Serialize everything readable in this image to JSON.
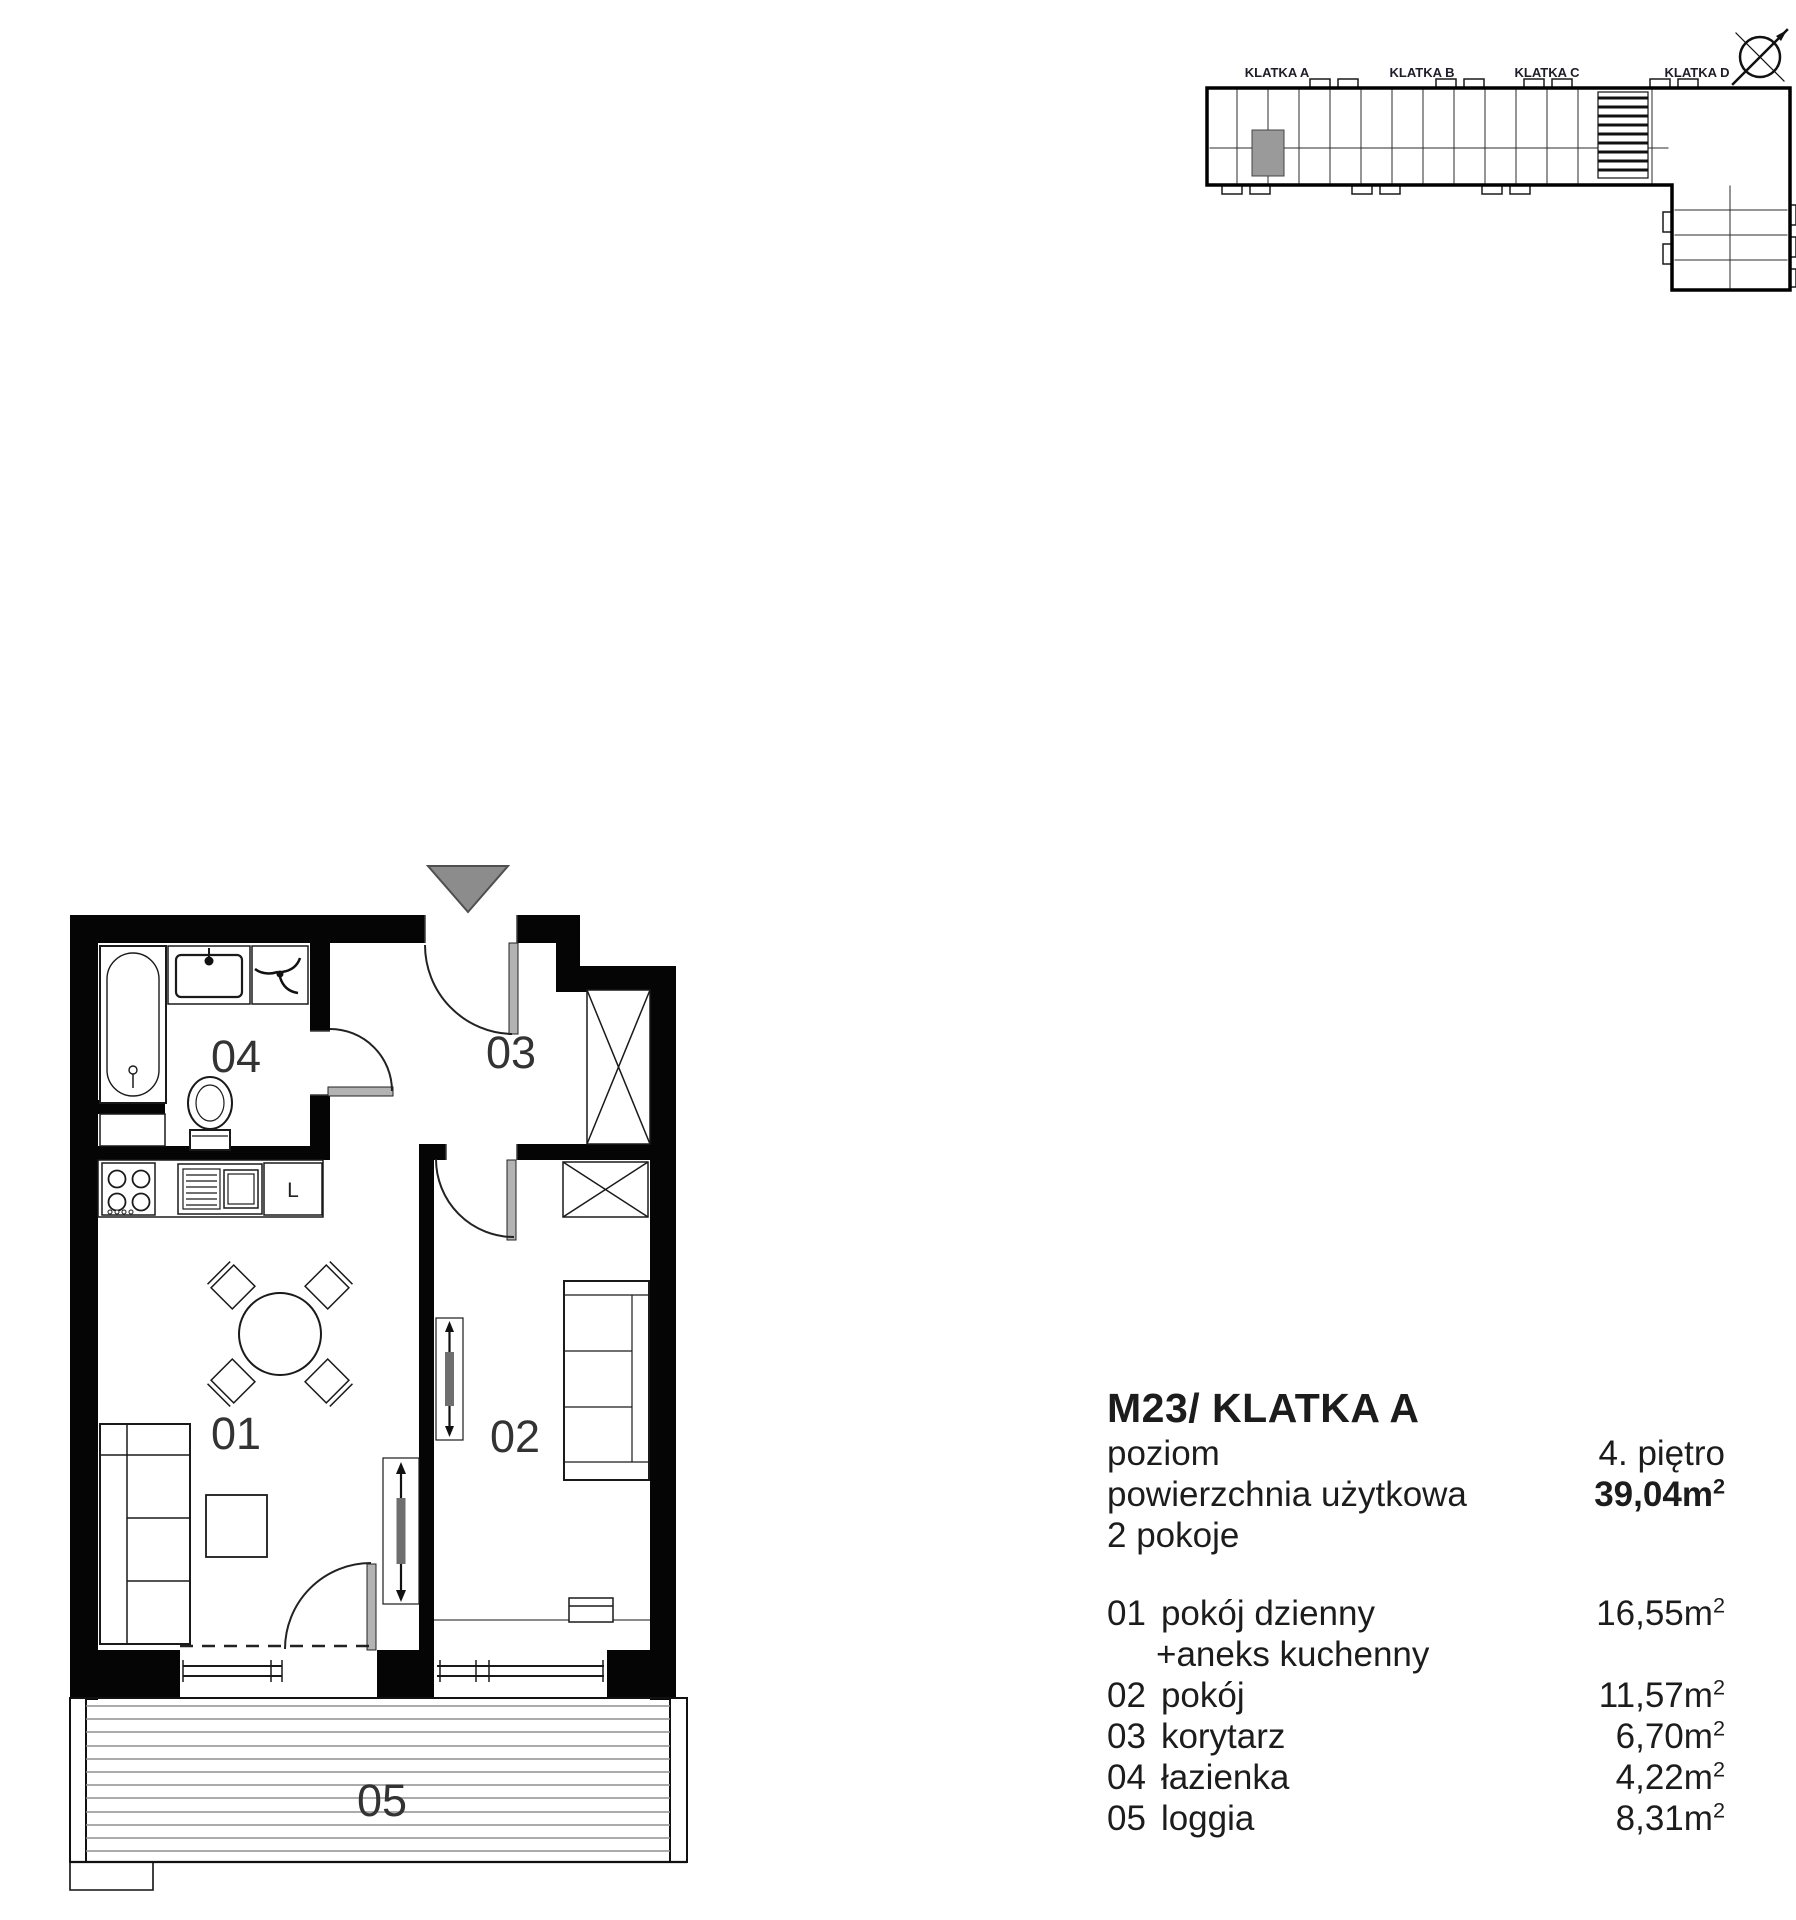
{
  "minimap": {
    "labels": [
      "KLATKA A",
      "KLATKA B",
      "KLATKA C",
      "KLATKA D"
    ],
    "highlight_color": "#9a9a9a"
  },
  "plan": {
    "labels": {
      "living": "01",
      "bedroom": "02",
      "hall": "03",
      "bath": "04",
      "loggia": "05"
    },
    "fridge_letter": "L"
  },
  "units": {
    "m": "m",
    "sup": "2"
  },
  "info": {
    "title": "M23/ KLATKA A",
    "level_label": "poziom",
    "level_value": "4. piętro",
    "area_label": "powierzchnia użytkowa",
    "area_value": "39,04",
    "rooms_count": "2 pokoje"
  },
  "legend": [
    {
      "num": "01",
      "name": "pokój dzienny",
      "name2": "+aneks kuchenny",
      "area": "16,55"
    },
    {
      "num": "02",
      "name": "pokój",
      "area": "11,57"
    },
    {
      "num": "03",
      "name": "korytarz",
      "area": "6,70"
    },
    {
      "num": "04",
      "name": "łazienka",
      "area": "4,22"
    },
    {
      "num": "05",
      "name": "loggia",
      "area": "8,31"
    }
  ]
}
